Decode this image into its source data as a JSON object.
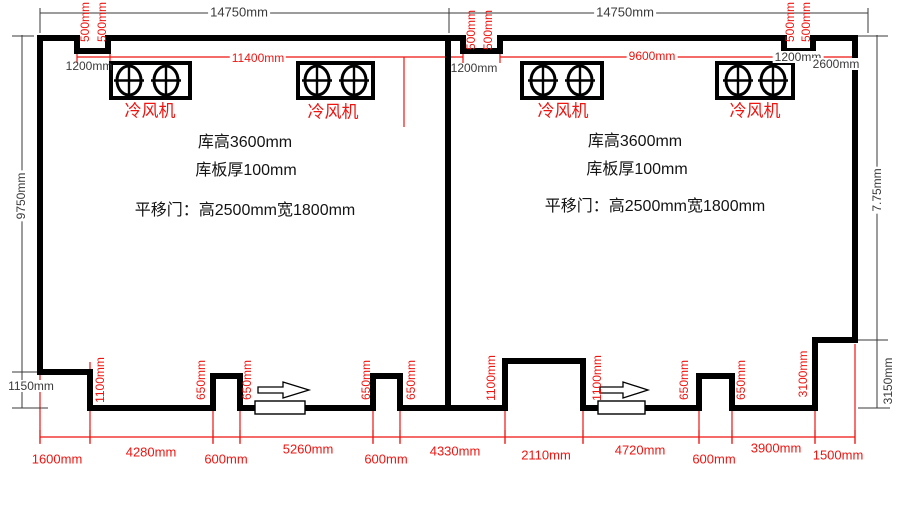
{
  "colors": {
    "wall": "#000000",
    "dim_line": "#3a3a3a",
    "red": "#ee1511",
    "note_text": "#141414"
  },
  "icons": {
    "fan_unit": "fan-unit-icon (rectangle with two crossed-circle blowers)",
    "door_arrow": "door-slide-direction-arrow-icon",
    "door_panel": "sliding-door-panel"
  },
  "annotations": [
    {
      "n": "dim-total-width-left",
      "t": "14750mm",
      "x": 239,
      "y": 12,
      "c": "dim",
      "s": 13,
      "bg": 1
    },
    {
      "n": "dim-total-width-right",
      "t": "14750mm",
      "x": 625,
      "y": 12,
      "c": "dim",
      "s": 13,
      "bg": 1
    },
    {
      "n": "dim-notch-offset-left",
      "t": "1200mm",
      "x": 89,
      "y": 66,
      "c": "dim",
      "s": 12
    },
    {
      "n": "dim-notch-offset-middle",
      "t": "1200mm",
      "x": 474,
      "y": 68,
      "c": "dim",
      "s": 12
    },
    {
      "n": "dim-notch-offset-right",
      "t": "1200mm",
      "x": 798,
      "y": 57,
      "c": "dim",
      "s": 12,
      "bg": 1
    },
    {
      "n": "dim-corner-right",
      "t": "2600mm",
      "x": 836,
      "y": 64,
      "c": "dim",
      "s": 12,
      "bg": 1
    },
    {
      "n": "dim-step-height-left",
      "t": "1150mm",
      "x": 31,
      "y": 386,
      "c": "dim",
      "s": 12,
      "bg": 1
    },
    {
      "n": "dim-side-height-left",
      "t": "9750mm",
      "x": 21,
      "y": 196,
      "c": "dim",
      "s": 12,
      "rot": 1,
      "bg": 1
    },
    {
      "n": "dim-side-height-right",
      "t": "7.75mm",
      "x": 877,
      "y": 190,
      "c": "dim",
      "s": 12,
      "rot": 1,
      "bg": 1
    },
    {
      "n": "dim-step-height-right",
      "t": "3150mm",
      "x": 888,
      "y": 381,
      "c": "dim",
      "s": 12,
      "rot": 1,
      "bg": 1
    },
    {
      "n": "note-room-height-left",
      "t": "库高3600mm",
      "x": 245,
      "y": 143,
      "c": "ink",
      "s": 16
    },
    {
      "n": "note-panel-thickness-left",
      "t": "库板厚100mm",
      "x": 246,
      "y": 171,
      "c": "ink",
      "s": 16
    },
    {
      "n": "note-sliding-door-left",
      "t": "平移门：高2500mm宽1800mm",
      "x": 245,
      "y": 211,
      "c": "ink",
      "s": 16
    },
    {
      "n": "note-room-height-right",
      "t": "库高3600mm",
      "x": 635,
      "y": 142,
      "c": "ink",
      "s": 16
    },
    {
      "n": "note-panel-thickness-right",
      "t": "库板厚100mm",
      "x": 637,
      "y": 170,
      "c": "ink",
      "s": 16
    },
    {
      "n": "note-sliding-door-right",
      "t": "平移门：高2500mm宽1800mm",
      "x": 655,
      "y": 207,
      "c": "ink",
      "s": 16
    },
    {
      "n": "dim-inner-width-left",
      "t": "11400mm",
      "x": 258,
      "y": 58,
      "c": "red",
      "s": 12,
      "bg": 1
    },
    {
      "n": "dim-inner-width-right",
      "t": "9600mm",
      "x": 652,
      "y": 56,
      "c": "red",
      "s": 12,
      "bg": 1
    },
    {
      "n": "dim-bottom-1600",
      "t": "1600mm",
      "x": 57,
      "y": 459,
      "c": "red",
      "s": 13
    },
    {
      "n": "dim-bottom-4280",
      "t": "4280mm",
      "x": 151,
      "y": 452,
      "c": "red",
      "s": 13,
      "bg": 1
    },
    {
      "n": "dim-bottom-600-a",
      "t": "600mm",
      "x": 226,
      "y": 459,
      "c": "red",
      "s": 13
    },
    {
      "n": "dim-bottom-5260",
      "t": "5260mm",
      "x": 308,
      "y": 449,
      "c": "red",
      "s": 13,
      "bg": 1
    },
    {
      "n": "dim-bottom-600-b",
      "t": "600mm",
      "x": 386,
      "y": 459,
      "c": "red",
      "s": 13
    },
    {
      "n": "dim-bottom-4330",
      "t": "4330mm",
      "x": 455,
      "y": 451,
      "c": "red",
      "s": 13,
      "bg": 1
    },
    {
      "n": "dim-bottom-2110",
      "t": "2110mm",
      "x": 546,
      "y": 455,
      "c": "red",
      "s": 13
    },
    {
      "n": "dim-bottom-4720",
      "t": "4720mm",
      "x": 640,
      "y": 450,
      "c": "red",
      "s": 13,
      "bg": 1
    },
    {
      "n": "dim-bottom-600-c",
      "t": "600mm",
      "x": 714,
      "y": 459,
      "c": "red",
      "s": 13
    },
    {
      "n": "dim-bottom-3900",
      "t": "3900mm",
      "x": 776,
      "y": 448,
      "c": "red",
      "s": 13,
      "bg": 1
    },
    {
      "n": "dim-bottom-1500",
      "t": "1500mm",
      "x": 838,
      "y": 455,
      "c": "red",
      "s": 13
    },
    {
      "n": "fan-label-left-1",
      "t": "冷风机",
      "x": 150,
      "y": 111,
      "c": "red",
      "s": 17
    },
    {
      "n": "fan-label-left-2",
      "t": "冷风机",
      "x": 333,
      "y": 112,
      "c": "red",
      "s": 17
    },
    {
      "n": "fan-label-right-1",
      "t": "冷风机",
      "x": 563,
      "y": 111,
      "c": "red",
      "s": 17
    },
    {
      "n": "fan-label-right-2",
      "t": "冷风机",
      "x": 755,
      "y": 111,
      "c": "red",
      "s": 17
    },
    {
      "n": "dim-notch-500-l1",
      "t": "500mm",
      "x": 85,
      "y": 22,
      "c": "red",
      "s": 12,
      "rot": 1
    },
    {
      "n": "dim-notch-500-l2",
      "t": "500mm",
      "x": 102,
      "y": 22,
      "c": "red",
      "s": 12,
      "rot": 1
    },
    {
      "n": "dim-notch-500-m1",
      "t": "500mm",
      "x": 471,
      "y": 30,
      "c": "red",
      "s": 12,
      "rot": 1
    },
    {
      "n": "dim-notch-500-m2",
      "t": "500mm",
      "x": 488,
      "y": 30,
      "c": "red",
      "s": 12,
      "rot": 1
    },
    {
      "n": "dim-notch-500-r1",
      "t": "500mm",
      "x": 790,
      "y": 22,
      "c": "red",
      "s": 12,
      "rot": 1
    },
    {
      "n": "dim-notch-500-r2",
      "t": "500mm",
      "x": 806,
      "y": 22,
      "c": "red",
      "s": 12,
      "rot": 1
    },
    {
      "n": "dim-1100-left-step",
      "t": "1100mm",
      "x": 100,
      "y": 380,
      "c": "red",
      "s": 12,
      "rot": 1
    },
    {
      "n": "dim-650-a",
      "t": "650mm",
      "x": 201,
      "y": 380,
      "c": "red",
      "s": 12,
      "rot": 1
    },
    {
      "n": "dim-650-b",
      "t": "650mm",
      "x": 247,
      "y": 380,
      "c": "red",
      "s": 12,
      "rot": 1
    },
    {
      "n": "dim-650-c",
      "t": "650mm",
      "x": 366,
      "y": 380,
      "c": "red",
      "s": 12,
      "rot": 1
    },
    {
      "n": "dim-650-d",
      "t": "650mm",
      "x": 411,
      "y": 380,
      "c": "red",
      "s": 12,
      "rot": 1
    },
    {
      "n": "dim-1100-mid-left",
      "t": "1100mm",
      "x": 491,
      "y": 378,
      "c": "red",
      "s": 12,
      "rot": 1
    },
    {
      "n": "dim-1100-mid-right",
      "t": "1100mm",
      "x": 597,
      "y": 378,
      "c": "red",
      "s": 12,
      "rot": 1
    },
    {
      "n": "dim-650-e",
      "t": "650mm",
      "x": 684,
      "y": 380,
      "c": "red",
      "s": 12,
      "rot": 1
    },
    {
      "n": "dim-650-f",
      "t": "650mm",
      "x": 741,
      "y": 380,
      "c": "red",
      "s": 12,
      "rot": 1
    },
    {
      "n": "dim-3100-right-step",
      "t": "3100mm",
      "x": 803,
      "y": 374,
      "c": "red",
      "s": 12,
      "rot": 1
    }
  ]
}
